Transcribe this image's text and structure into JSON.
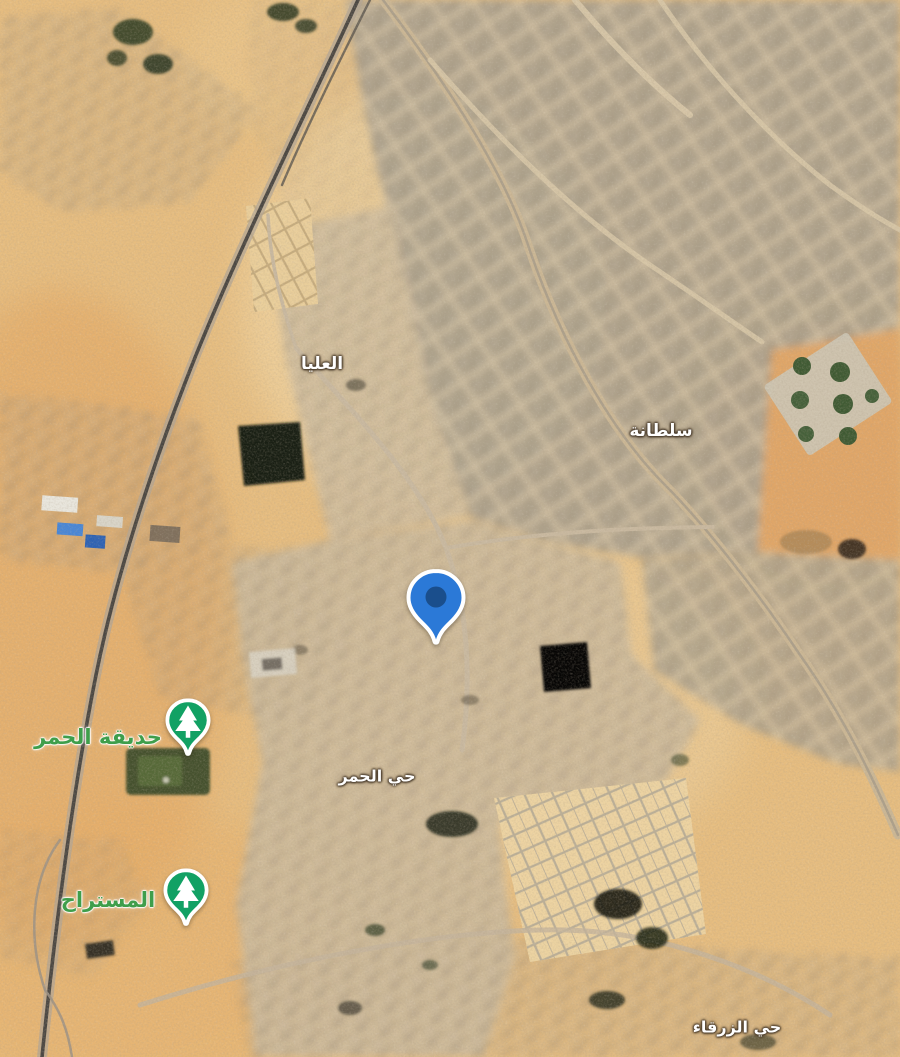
{
  "app": {
    "view": "satellite-map"
  },
  "map": {
    "neighborhood_labels": [
      {
        "label": "العليا",
        "x": 322,
        "y": 364
      },
      {
        "label": "سلطانة",
        "x": 661,
        "y": 431
      },
      {
        "label": "حي الحمر",
        "x": 377,
        "y": 776
      },
      {
        "label": "حي الزرقاء",
        "x": 737,
        "y": 1027
      }
    ],
    "park_labels": [
      {
        "label": "حديقة الحمر",
        "x": 98,
        "y": 737
      },
      {
        "label": "المستراح",
        "x": 108,
        "y": 900
      }
    ],
    "markers": {
      "selected_pin": {
        "x": 436,
        "y": 648,
        "color": "#2b79d7",
        "dot_color": "#1a4e8c",
        "outline": "#ffffff"
      },
      "park_markers": [
        {
          "park": "حديقة الحمر",
          "icon": "tree",
          "x": 188,
          "y": 758,
          "color": "#12a164",
          "outline": "#ffffff"
        },
        {
          "park": "المستراح",
          "icon": "tree",
          "x": 186,
          "y": 928,
          "color": "#12a164",
          "outline": "#ffffff"
        }
      ]
    },
    "colors": {
      "sand": "#e6bd80",
      "sand_orange": "#e2a564",
      "urban_block": "#b2a793",
      "road": "#cbb795",
      "railway": "#4c4843",
      "park_green": "#44512d",
      "dark_farm": "#10150e",
      "pool_blue": "#4886d6",
      "label_white": "#ffffff",
      "label_green": "#3f9e4b"
    }
  }
}
